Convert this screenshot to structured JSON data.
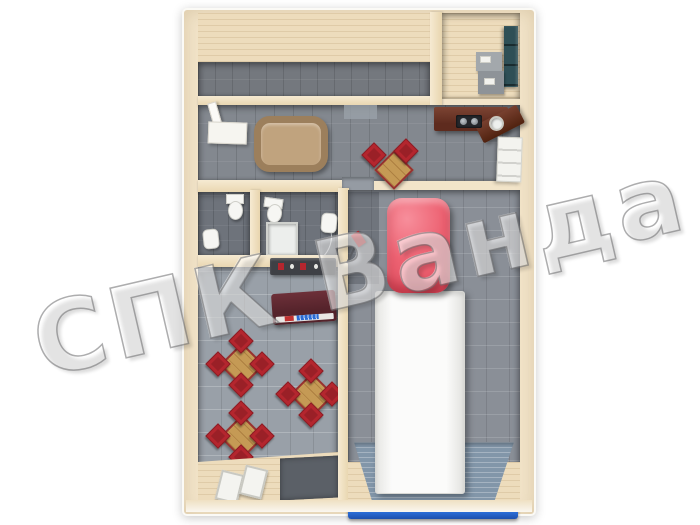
{
  "watermark": {
    "text": "СПК Ванда"
  },
  "scene": {
    "kind": "3d-floorplan-top-view",
    "areas": [
      "workshop-room",
      "storage-office",
      "hallway-with-kitchen",
      "wc",
      "wc-with-shower",
      "cafe-seating",
      "garage-bay",
      "entry-vestibule"
    ],
    "inventory": {
      "dining_tables": 4,
      "red_chairs": 14,
      "sofas": 1,
      "toilets": 2,
      "wash_basins": 3,
      "shower_trays": 1,
      "kitchen_counters": 1,
      "teal_lockers": 1,
      "reception_counters": 1,
      "doormats": 2,
      "box_trucks": 1,
      "roller_doors": 1,
      "floor_jacks": 1
    }
  },
  "colors": {
    "wall": "#f2e4c9",
    "wall_edge": "#fbfaf6",
    "plank": "#eddcbc",
    "tile_room": "#74787e",
    "tile_hall": "#83888f",
    "tile_bath": "#6e737b",
    "tile_cafe": "#99a0a8",
    "tile_garage": "#8a8f97",
    "truck_cab": "#ed6272",
    "truck_box": "#fbfbfa",
    "door_blue": "#2a6bd4",
    "chair_red": "#b4262e",
    "table_wood": "#c59a55",
    "counter_wood": "#5e2b1e",
    "bar_maroon": "#55232b",
    "cabinet_teal": "#2e4f56",
    "sofa_tan": "#c0a37e",
    "ramp_blue": "#8296a9",
    "fixture_white": "#f6f6f3"
  }
}
